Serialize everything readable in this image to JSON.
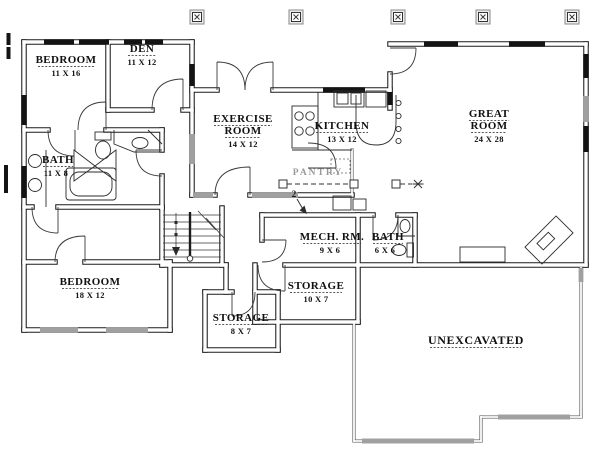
{
  "rooms": {
    "bedroom1": {
      "name": "BEDROOM",
      "dims": "11 X 16"
    },
    "den": {
      "name": "DEN",
      "dims": "11 X 12"
    },
    "exercise": {
      "name_line1": "EXERCISE",
      "name_line2": "ROOM",
      "dims": "14 X 12"
    },
    "kitchen": {
      "name": "KITCHEN",
      "dims": "13 X 12"
    },
    "great_room": {
      "name_line1": "GREAT",
      "name_line2": "ROOM",
      "dims": "24 X 28"
    },
    "bath_main": {
      "name": "BATH",
      "dims": "11 X 8"
    },
    "mech_room": {
      "name": "MECH. RM.",
      "dims": "9 X 6"
    },
    "bath_small": {
      "name": "BATH",
      "dims": "6 X 6"
    },
    "storage_large": {
      "name": "STORAGE",
      "dims": "10 X 7"
    },
    "bedroom2": {
      "name": "BEDROOM",
      "dims": "18 X 12"
    },
    "storage_small": {
      "name": "STORAGE",
      "dims": "8 X 7"
    },
    "unexcavated": {
      "name": "UNEXCAVATED"
    },
    "pantry": {
      "name": "PANTRY"
    }
  },
  "annotations": {
    "section_marker": "2"
  },
  "colors": {
    "line": "#1c1c1c",
    "window": "#141414",
    "hatch": "#a0a0a0",
    "background": "#ffffff"
  }
}
